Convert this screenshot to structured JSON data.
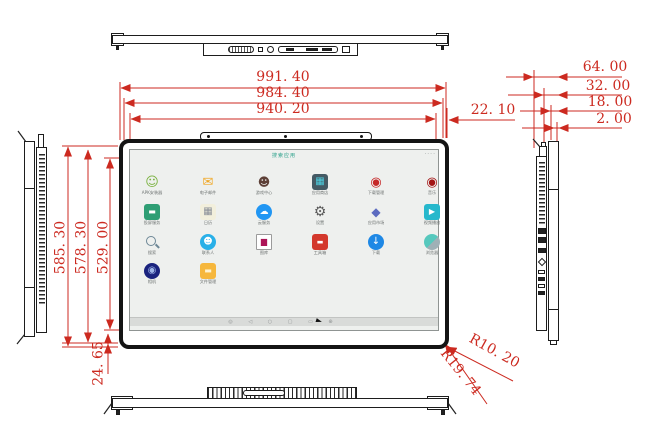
{
  "drawing": {
    "accent_red": "#cc2a20",
    "line_black": "#1d1d1d",
    "views": [
      "top-view",
      "front-view",
      "bottom-view",
      "left-side-view",
      "right-side-view"
    ]
  },
  "dims": {
    "d991": "991. 40",
    "d984": "984. 40",
    "d940": "940. 20",
    "d2210": "22. 10",
    "d64": "64. 00",
    "d32": "32. 00",
    "d18": "18. 00",
    "d2": "2. 00",
    "d585": "585. 30",
    "d578": "578. 30",
    "d529": "529. 00",
    "d2465": "24. 65",
    "r1": "R10. 20",
    "r2": "R19. 74"
  },
  "screen": {
    "status_text": "搜索应用",
    "statusbar_dots": "····",
    "nav_icons": "◎ ◁ ○ ▢ ▭ ⊕"
  },
  "apps": [
    {
      "name": "app-apk-installer",
      "label": "APK安装器",
      "kind": "glyph",
      "shape": "none",
      "glyph": "☺",
      "fg": "#7cb342",
      "bg": "",
      "size": 13
    },
    {
      "name": "app-email",
      "label": "电子邮件",
      "kind": "glyph",
      "shape": "none",
      "glyph": "✉",
      "fg": "#f0a828",
      "bg": "",
      "size": 13
    },
    {
      "name": "app-game-center",
      "label": "游戏中心",
      "kind": "glyph",
      "shape": "none",
      "glyph": "☻",
      "fg": "#5d4037",
      "bg": "",
      "size": 12
    },
    {
      "name": "app-store",
      "label": "应用商店",
      "kind": "glyph",
      "shape": "rsq",
      "glyph": "▦",
      "fg": "#4dd0e1",
      "bg": "#455a64",
      "size": 10
    },
    {
      "name": "app-download-manager",
      "label": "下载管理",
      "kind": "glyph",
      "shape": "none",
      "glyph": "◉",
      "fg": "#c62828",
      "bg": "",
      "size": 13
    },
    {
      "name": "app-music",
      "label": "音乐",
      "kind": "glyph",
      "shape": "none",
      "glyph": "◉",
      "fg": "#a31515",
      "bg": "",
      "size": 13
    },
    {
      "name": "app-screen-service",
      "label": "投屏服务",
      "kind": "glyph",
      "shape": "rsq",
      "glyph": "▬",
      "fg": "#ffffff",
      "bg": "#2e9e74",
      "size": 8
    },
    {
      "name": "app-calendar",
      "label": "日历",
      "kind": "glyph",
      "shape": "rsq",
      "glyph": "▦",
      "fg": "#8a8f98",
      "bg": "#f2efdc",
      "size": 10
    },
    {
      "name": "app-cloud",
      "label": "云服务",
      "kind": "glyph",
      "shape": "circle",
      "glyph": "☁",
      "fg": "#ffffff",
      "bg": "#2196f3",
      "size": 9
    },
    {
      "name": "app-settings",
      "label": "设置",
      "kind": "glyph",
      "shape": "none",
      "glyph": "⚙",
      "fg": "#5a5a5a",
      "bg": "",
      "size": 14
    },
    {
      "name": "app-market",
      "label": "应用市场",
      "kind": "glyph",
      "shape": "none",
      "glyph": "◆",
      "fg": "#5c6bc0",
      "bg": "",
      "size": 12
    },
    {
      "name": "app-video-player",
      "label": "视频播放",
      "kind": "glyph",
      "shape": "rsq",
      "glyph": "▶",
      "fg": "#ffffff",
      "bg": "#26b8cc",
      "size": 8
    },
    {
      "name": "app-search",
      "label": "搜索",
      "kind": "magnifier",
      "shape": "none",
      "glyph": "",
      "fg": "",
      "bg": "",
      "size": 0
    },
    {
      "name": "app-contacts",
      "label": "联系人",
      "kind": "glyph",
      "shape": "circle",
      "glyph": "☻",
      "fg": "#ffffff",
      "bg": "#29b0e8",
      "size": 9
    },
    {
      "name": "app-gallery",
      "label": "图库",
      "kind": "glyph",
      "shape": "frame",
      "glyph": "▆",
      "fg": "#ad1457",
      "bg": "",
      "size": 8
    },
    {
      "name": "app-toolbox",
      "label": "工具箱",
      "kind": "glyph",
      "shape": "rsq",
      "glyph": "▬",
      "fg": "#ffffff",
      "bg": "#d3382c",
      "size": 7
    },
    {
      "name": "app-downloads",
      "label": "下载",
      "kind": "glyph",
      "shape": "circle",
      "glyph": "↓",
      "fg": "#ffffff",
      "bg": "#1e88e5",
      "size": 10
    },
    {
      "name": "app-browser",
      "label": "浏览器",
      "kind": "sphere",
      "shape": "circle",
      "glyph": "",
      "fg": "",
      "bg": "",
      "size": 0
    },
    {
      "name": "app-camera",
      "label": "相机",
      "kind": "glyph",
      "shape": "circle",
      "glyph": "◉",
      "fg": "#9fb6e8",
      "bg": "#1a237e",
      "size": 10
    },
    {
      "name": "app-file-manager",
      "label": "文件管理",
      "kind": "glyph",
      "shape": "rsq",
      "glyph": "▬",
      "fg": "#fff3d0",
      "bg": "#f6b73c",
      "size": 8
    }
  ]
}
